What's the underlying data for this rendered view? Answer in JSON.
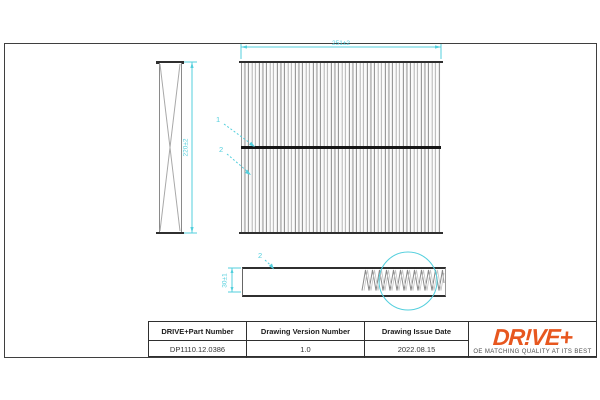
{
  "drawing": {
    "dimensions": {
      "main_width": "251±2",
      "side_height": "220±2",
      "profile_height": "30±1"
    },
    "callouts": {
      "main_top": "1",
      "main_bottom": "2",
      "profile": "2"
    }
  },
  "title_block": {
    "columns": [
      {
        "header": "DRIVE+Part Number",
        "value": "DP1110.12.0386"
      },
      {
        "header": "Drawing Version Number",
        "value": "1.0"
      },
      {
        "header": "Drawing Issue Date",
        "value": "2022.08.15"
      }
    ]
  },
  "brand": {
    "logo": "DR!VE+",
    "tagline": "OE MATCHING QUALITY AT ITS BEST",
    "logo_color": "#e7571f"
  },
  "colors": {
    "dimension_cyan": "#53cfdd",
    "line_dark": "#2f2f2f",
    "pleat_gray": "#999999"
  }
}
